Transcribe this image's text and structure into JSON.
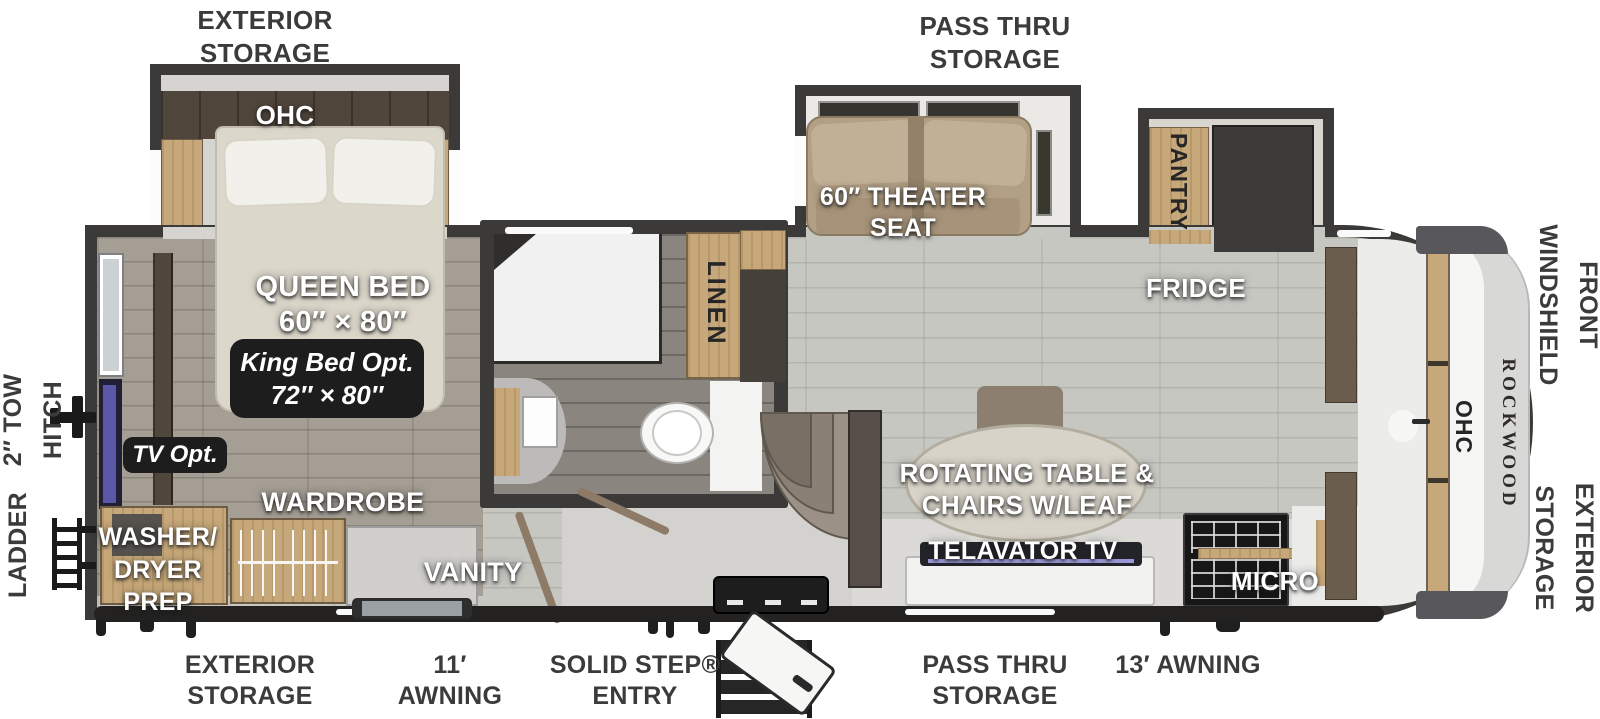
{
  "title": "Rockwood fifth wheel RV floor plan",
  "colors": {
    "wall": "#3b3a38",
    "floor_main": "#c6c7c1",
    "floor_bedroom": "#a49e94",
    "cabinet_tan": "#c7a87a",
    "badge_bg": "#1d1d1d",
    "label_outside": "#3b3b3a",
    "accent_cap_gray": "#d8d8d6"
  },
  "labels": {
    "exterior": {
      "storage_top_left": "EXTERIOR\nSTORAGE",
      "pass_thru_top": "PASS THRU\nSTORAGE",
      "front_windshield": "FRONT\nWINDSHIELD",
      "exterior_storage_front": "EXTERIOR\nSTORAGE",
      "tow_hitch": "2″ TOW\nHITCH",
      "ladder": "LADDER",
      "storage_bottom_left": "EXTERIOR\nSTORAGE",
      "awning_11": "11′\nAWNING",
      "solid_step_entry": "SOLID STEP®\nENTRY",
      "pass_thru_bottom": "PASS THRU\nSTORAGE",
      "awning_13": "13′ AWNING"
    },
    "interior": {
      "ohc_bedroom": "OHC",
      "queen_bed": "QUEEN BED\n60″ × 80″",
      "king_bed_option": "King Bed Opt.\n72″ × 80″",
      "tv_option": "TV Opt.",
      "wardrobe": "WARDROBE",
      "washer_dryer_prep": "WASHER/\nDRYER\nPREP",
      "vanity": "VANITY",
      "linen": "LINEN",
      "theater_seat": "60″ THEATER\nSEAT",
      "pantry": "PANTRY",
      "fridge": "FRIDGE",
      "rotating_table": "ROTATING TABLE &\nCHAIRS W/LEAF",
      "televator_tv": "TELAVATOR TV",
      "micro": "MICRO",
      "ohc_front": "OHC",
      "brand": "ROCKWOOD"
    }
  }
}
